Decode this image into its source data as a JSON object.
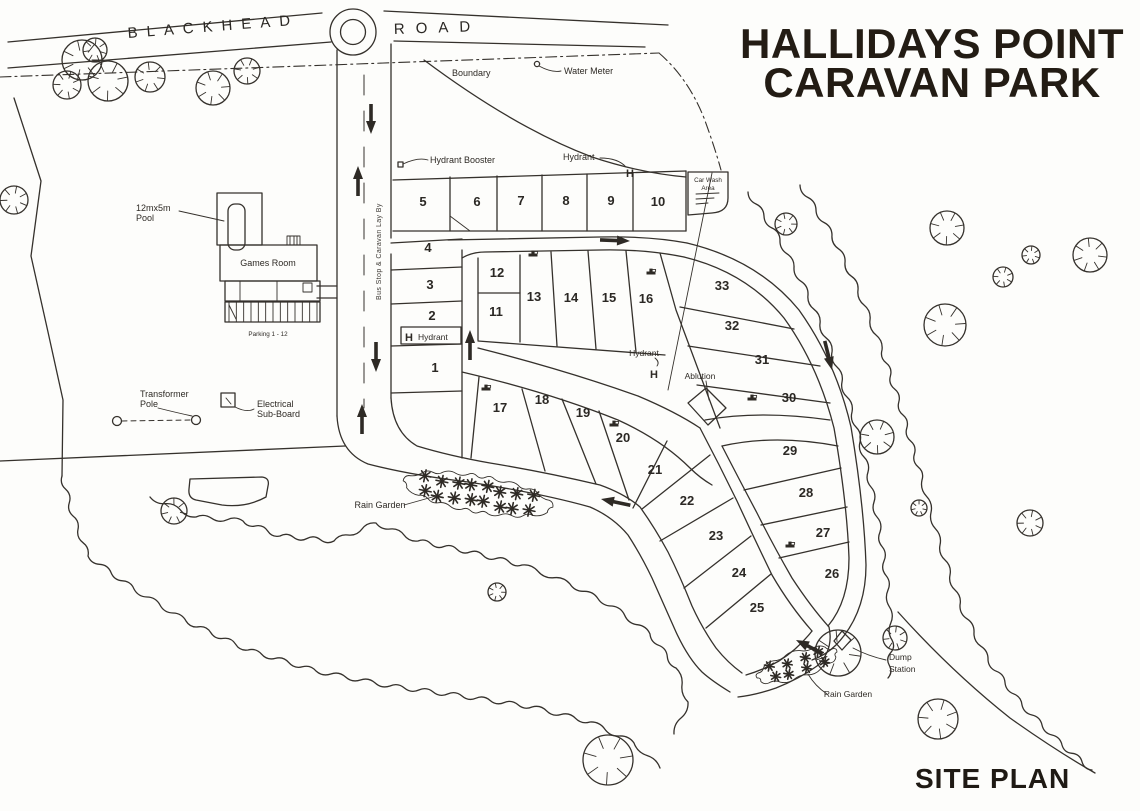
{
  "title": {
    "line1": "HALLIDAYS POINT",
    "line2": "CARAVAN PARK"
  },
  "footer": {
    "site_plan": "SITE PLAN"
  },
  "roads": {
    "blackhead": "BLACKHEAD",
    "road_word": "ROAD",
    "bus_stop_layby": "Bus Stop & Caravan Lay By"
  },
  "labels": {
    "boundary": "Boundary",
    "water_meter": "Water Meter",
    "hydrant_booster": "Hydrant Booster",
    "hydrant": "Hydrant",
    "hydrant_symbol": "H",
    "car_wash_line1": "Car Wash",
    "car_wash_line2": "Area",
    "pool_line1": "12mx5m",
    "pool_line2": "Pool",
    "games_room": "Games Room",
    "parking": "Parking 1 - 12",
    "transformer_line1": "Transformer",
    "transformer_line2": "Pole",
    "electrical_line1": "Electrical",
    "electrical_line2": "Sub-Board",
    "ablution": "Ablution",
    "rain_garden": "Rain Garden",
    "dump_line1": "Dump",
    "dump_line2": "Station"
  },
  "colors": {
    "ink": "#35312c",
    "title_ink": "#231c14",
    "paper": "#fdfdfb"
  },
  "lots": [
    {
      "n": "1",
      "x": 435,
      "y": 372
    },
    {
      "n": "2",
      "x": 432,
      "y": 320
    },
    {
      "n": "3",
      "x": 430,
      "y": 289
    },
    {
      "n": "4",
      "x": 428,
      "y": 252
    },
    {
      "n": "5",
      "x": 423,
      "y": 206
    },
    {
      "n": "6",
      "x": 477,
      "y": 206
    },
    {
      "n": "7",
      "x": 521,
      "y": 205
    },
    {
      "n": "8",
      "x": 566,
      "y": 205
    },
    {
      "n": "9",
      "x": 611,
      "y": 205
    },
    {
      "n": "10",
      "x": 658,
      "y": 206
    },
    {
      "n": "11",
      "x": 496,
      "y": 316
    },
    {
      "n": "12",
      "x": 497,
      "y": 277
    },
    {
      "n": "13",
      "x": 534,
      "y": 301
    },
    {
      "n": "14",
      "x": 571,
      "y": 302
    },
    {
      "n": "15",
      "x": 609,
      "y": 302
    },
    {
      "n": "16",
      "x": 646,
      "y": 303
    },
    {
      "n": "17",
      "x": 500,
      "y": 412
    },
    {
      "n": "18",
      "x": 542,
      "y": 404
    },
    {
      "n": "19",
      "x": 583,
      "y": 417
    },
    {
      "n": "20",
      "x": 623,
      "y": 442
    },
    {
      "n": "21",
      "x": 655,
      "y": 474
    },
    {
      "n": "22",
      "x": 687,
      "y": 505
    },
    {
      "n": "23",
      "x": 716,
      "y": 540
    },
    {
      "n": "24",
      "x": 739,
      "y": 577
    },
    {
      "n": "25",
      "x": 757,
      "y": 612
    },
    {
      "n": "26",
      "x": 832,
      "y": 578
    },
    {
      "n": "27",
      "x": 823,
      "y": 537
    },
    {
      "n": "28",
      "x": 806,
      "y": 497
    },
    {
      "n": "29",
      "x": 790,
      "y": 455
    },
    {
      "n": "30",
      "x": 789,
      "y": 402
    },
    {
      "n": "31",
      "x": 762,
      "y": 364
    },
    {
      "n": "32",
      "x": 732,
      "y": 330
    },
    {
      "n": "33",
      "x": 722,
      "y": 290
    }
  ],
  "trees": [
    {
      "x": 82,
      "y": 60,
      "r": 20
    },
    {
      "x": 108,
      "y": 81,
      "r": 20
    },
    {
      "x": 67,
      "y": 85,
      "r": 14
    },
    {
      "x": 95,
      "y": 50,
      "r": 12
    },
    {
      "x": 150,
      "y": 77,
      "r": 15
    },
    {
      "x": 213,
      "y": 88,
      "r": 17
    },
    {
      "x": 247,
      "y": 71,
      "r": 13
    },
    {
      "x": 14,
      "y": 200,
      "r": 14
    },
    {
      "x": 174,
      "y": 511,
      "r": 13
    },
    {
      "x": 786,
      "y": 224,
      "r": 11
    },
    {
      "x": 947,
      "y": 228,
      "r": 17
    },
    {
      "x": 1003,
      "y": 277,
      "r": 10
    },
    {
      "x": 1031,
      "y": 255,
      "r": 9
    },
    {
      "x": 1090,
      "y": 255,
      "r": 17
    },
    {
      "x": 945,
      "y": 325,
      "r": 21
    },
    {
      "x": 877,
      "y": 437,
      "r": 17
    },
    {
      "x": 1030,
      "y": 523,
      "r": 13
    },
    {
      "x": 919,
      "y": 508,
      "r": 8
    },
    {
      "x": 497,
      "y": 592,
      "r": 9
    },
    {
      "x": 608,
      "y": 760,
      "r": 25
    },
    {
      "x": 938,
      "y": 719,
      "r": 20
    },
    {
      "x": 895,
      "y": 638,
      "r": 12
    },
    {
      "x": 838,
      "y": 653,
      "r": 23
    }
  ]
}
